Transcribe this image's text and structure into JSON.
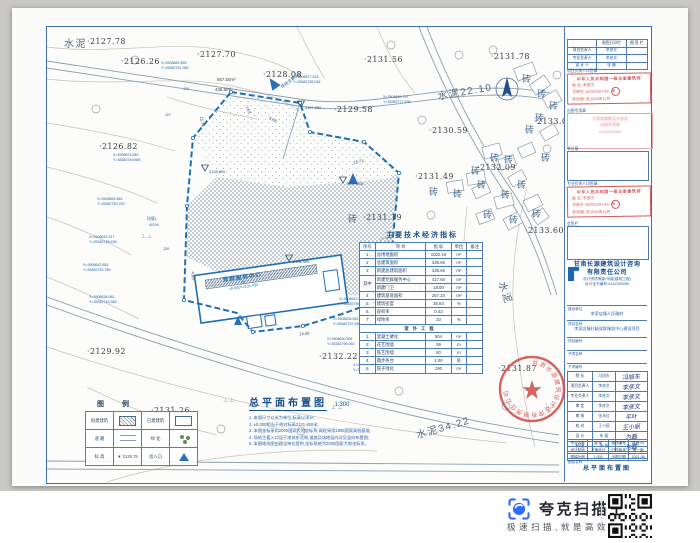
{
  "colors": {
    "frame_blue": "#3f6fae",
    "boundary_blue": "#1f6fb5",
    "stamp_red": "#cf4a4a",
    "brand_blue": "#2f6bff",
    "contour_tan": "#c8c1b2"
  },
  "drawing": {
    "title": "总平面布置图",
    "scale": "1:300",
    "notes": [
      "1. 本图尺寸以米为单位,标高以米计;",
      "2. ±0.000相当于绝对标高2131.450米;",
      "3. 本图坐标采用2000国家大地坐标系,高程采用1985国家高程基准;",
      "4. 场地主要入口设于地块东北侧,道路及场地竖向详见竖向布置图;",
      "5. 本图地形图由建设单位提供,坐标系统为2000国家大地坐标系。"
    ]
  },
  "map": {
    "brick_char": "砖",
    "grass_char": "⊥⊥",
    "entrance_label": "场地主要入口",
    "building": {
      "name": "党群服务中心",
      "floor": "1F",
      "elev": "±0.000=2131.450"
    },
    "spot_elevations": [
      {
        "x": 40,
        "y": 10,
        "t": "2127.78"
      },
      {
        "x": 74,
        "y": 30,
        "t": "2126.26"
      },
      {
        "x": 150,
        "y": 23,
        "t": "2127.70"
      },
      {
        "x": 216,
        "y": 43,
        "t": "2128.08"
      },
      {
        "x": 287,
        "y": 78,
        "t": "2129.58"
      },
      {
        "x": 317,
        "y": 28,
        "t": "2131.56"
      },
      {
        "x": 444,
        "y": 25,
        "t": "2131.78"
      },
      {
        "x": 52,
        "y": 115,
        "t": "2126.82"
      },
      {
        "x": 382,
        "y": 99,
        "t": "2130.59"
      },
      {
        "x": 487,
        "y": 90,
        "t": "2133.07"
      },
      {
        "x": 368,
        "y": 145,
        "t": "2131.49"
      },
      {
        "x": 430,
        "y": 136,
        "t": "2132.09"
      },
      {
        "x": 316,
        "y": 186,
        "t": "2131.19"
      },
      {
        "x": 478,
        "y": 199,
        "t": "2133.60"
      },
      {
        "x": 40,
        "y": 320,
        "t": "2129.92"
      },
      {
        "x": 272,
        "y": 325,
        "t": "2132.22"
      },
      {
        "x": 451,
        "y": 337,
        "t": "2131.87"
      },
      {
        "x": 104,
        "y": 379,
        "t": "2131.26"
      },
      {
        "x": 362,
        "y": 256,
        "t": "2131.67"
      }
    ],
    "region_labels": [
      {
        "x": 17,
        "y": 8,
        "t": "水泥",
        "rot": 0
      },
      {
        "x": 390,
        "y": 56,
        "t": "水泥22.10",
        "rot": -10
      },
      {
        "x": 448,
        "y": 258,
        "t": "水泥",
        "rot": 72
      },
      {
        "x": 368,
        "y": 392,
        "t": "水泥34.22",
        "rot": -16
      }
    ],
    "bricks": [
      {
        "x": 475,
        "y": 45
      },
      {
        "x": 490,
        "y": 60
      },
      {
        "x": 502,
        "y": 72
      },
      {
        "x": 488,
        "y": 84
      },
      {
        "x": 478,
        "y": 96
      },
      {
        "x": 443,
        "y": 124
      },
      {
        "x": 457,
        "y": 126
      },
      {
        "x": 494,
        "y": 124
      },
      {
        "x": 424,
        "y": 137
      },
      {
        "x": 430,
        "y": 151
      },
      {
        "x": 470,
        "y": 151
      },
      {
        "x": 454,
        "y": 161
      },
      {
        "x": 406,
        "y": 160
      },
      {
        "x": 382,
        "y": 158
      },
      {
        "x": 436,
        "y": 181
      },
      {
        "x": 462,
        "y": 186
      },
      {
        "x": 485,
        "y": 180
      },
      {
        "x": 301,
        "y": 185
      }
    ],
    "coord_callouts": [
      {
        "x": 114,
        "y": 34,
        "xv": "X=3908682.855",
        "yv": "Y=35382751.380"
      },
      {
        "x": 246,
        "y": 48,
        "xv": "X=3908677.215",
        "yv": "Y=35382766.044"
      },
      {
        "x": 336,
        "y": 68,
        "xv": "X=3908669.757",
        "yv": "Y=35382777.536"
      },
      {
        "x": 66,
        "y": 126,
        "xv": "X=3908674.840",
        "yv": "Y=35382749.865"
      },
      {
        "x": 50,
        "y": 170,
        "xv": "X=3908652.882",
        "yv": "Y=35382750.750"
      },
      {
        "x": 42,
        "y": 208,
        "xv": "X=3908643.217",
        "yv": "Y=35382748.638"
      },
      {
        "x": 36,
        "y": 236,
        "xv": "X=3908642.851",
        "yv": "Y=35382743.789"
      },
      {
        "x": 42,
        "y": 268,
        "xv": "X=3908638.081",
        "yv": "Y=35382743.366"
      },
      {
        "x": 292,
        "y": 270,
        "xv": "X=3908642.864",
        "yv": "Y=35382796.363"
      },
      {
        "x": 286,
        "y": 290,
        "xv": "X=3908635.961",
        "yv": "Y=35382797.969"
      },
      {
        "x": 280,
        "y": 310,
        "xv": "X=3908630.654",
        "yv": "Y=35382796.062"
      },
      {
        "x": 306,
        "y": 336,
        "xv": "X=3908626.177",
        "yv": "Y=35382757.662"
      },
      {
        "x": 402,
        "y": 240,
        "xv": "X=3908669.751",
        "yv": "Y=35382775.536"
      },
      {
        "x": 406,
        "y": 262,
        "xv": "X=3908638.347",
        "yv": "Y=35382788.062"
      }
    ],
    "dims": [
      {
        "x": 306,
        "y": 132,
        "t": "13.71",
        "rot": -12
      },
      {
        "x": 252,
        "y": 304,
        "t": "14.49",
        "rot": -4
      },
      {
        "x": 222,
        "y": 90,
        "t": "6.66",
        "rot": 25
      },
      {
        "x": 197,
        "y": 80,
        "t": "7.63",
        "rot": 65
      },
      {
        "x": 150,
        "y": 92,
        "t": "15.74",
        "rot": 80
      },
      {
        "x": 142,
        "y": 246,
        "t": "4.09",
        "rot": 85
      }
    ],
    "areas": [
      {
        "x": 170,
        "y": 50,
        "t": "567.50m²"
      },
      {
        "x": 168,
        "y": 60,
        "t": "436.9m²"
      }
    ],
    "misc": [
      {
        "x": 100,
        "y": 190,
        "t": "挡墙1"
      },
      {
        "x": 102,
        "y": 196,
        "t": "4/S04"
      },
      {
        "x": 116,
        "y": 220,
        "t": "J26"
      },
      {
        "x": 118,
        "y": 86,
        "t": "J27"
      },
      {
        "x": 136,
        "y": 60,
        "t": "J20"
      }
    ],
    "grass": [
      {
        "x": 176,
        "y": 370
      },
      {
        "x": 284,
        "y": 377
      },
      {
        "x": 497,
        "y": 376
      },
      {
        "x": 94,
        "y": 206
      }
    ],
    "elev_markers": [
      {
        "x": 162,
        "y": 142,
        "t": "2128.800"
      },
      {
        "x": 258,
        "y": 78,
        "t": "2127.850"
      },
      {
        "x": 300,
        "y": 154,
        "t": "2129.825"
      },
      {
        "x": 246,
        "y": 232,
        "t": "2131.450"
      }
    ]
  },
  "indicators": {
    "title": "主要技术经济指标",
    "headers": [
      "序号",
      "项  目",
      "指  标",
      "单位",
      "备注"
    ],
    "rows": [
      [
        "1",
        "总用地面积",
        "1022.19",
        "m²",
        ""
      ],
      [
        "2",
        "总建筑面积",
        "435.60",
        "m²",
        ""
      ],
      [
        "3",
        "新建总建筑面积",
        "435.60",
        "m²",
        ""
      ],
      [
        "其中",
        "新建党群服务中心",
        "417.60",
        "m²",
        ""
      ],
      [
        "",
        "新建门卫",
        "18.00",
        "m²",
        ""
      ],
      [
        "4",
        "建筑基底面积",
        "257.10",
        "m²",
        ""
      ],
      [
        "5",
        "建筑密度",
        "26.93",
        "%",
        ""
      ],
      [
        "6",
        "容积率",
        "0.43",
        "",
        ""
      ],
      [
        "7",
        "绿地率",
        "33",
        "%",
        ""
      ]
    ],
    "section": "室外工程",
    "rows2": [
      [
        "1",
        "混凝土硬化",
        "504",
        "m²",
        ""
      ],
      [
        "2",
        "花艺围墙",
        "39",
        "m",
        ""
      ],
      [
        "3",
        "铁艺围墙",
        "60",
        "m",
        ""
      ],
      [
        "4",
        "踏步条台",
        "1.00",
        "处",
        ""
      ],
      [
        "5",
        "院子绿化",
        "190",
        "m²",
        ""
      ]
    ]
  },
  "legend": {
    "title": "图  例",
    "elev_value": "2128.75",
    "items": [
      {
        "label": "拟建建筑",
        "symbol": "hatch"
      },
      {
        "label": "已建建筑",
        "symbol": "rect"
      },
      {
        "label": "道  路",
        "symbol": "road"
      },
      {
        "label": "绿  化",
        "symbol": "green"
      },
      {
        "label": "标  高",
        "symbol": "elev"
      },
      {
        "label": "总入口",
        "symbol": "entry"
      }
    ]
  },
  "titleblock": {
    "top_table": {
      "header": [
        "",
        "图签打印栏",
        "图 签 栏"
      ],
      "rows": [
        [
          "项目负责人",
          "李彦文"
        ],
        [
          "专业负责人",
          "李彦文"
        ],
        [
          "设 计 人",
          "张 巍"
        ]
      ]
    },
    "sec_labels": [
      "项目负责人印签章",
      "出图专用章",
      "单位章",
      "专业负责人印签章",
      "会签栏"
    ],
    "stamp": {
      "line1": "中华人民共和国一级注册建筑师",
      "name_label": "姓 名:",
      "name": "李彦文",
      "reg_label": "注册号:",
      "reg": "6200229-016",
      "valid_label": "有效期:",
      "valid": "至2026年11月",
      "seal_char": "章"
    },
    "pink_stamp": [
      "甘肃省勘察设计协会",
      "出图专用章",
      "A162005085"
    ],
    "company": {
      "name1": "甘肃长源建筑设计咨询",
      "name2": "有限责任公司",
      "grade": "设计资质等级:甲级(建筑工程)",
      "cert": "设计证书编号:A162005085"
    },
    "fields": [
      {
        "label": "建设单位",
        "value": "李家店镇人民政府"
      },
      {
        "label": "项目名称",
        "value": "李家店镇村级党群服务中心建设项目"
      },
      {
        "label": "项目编号",
        "value": ""
      },
      {
        "label": "子项名称",
        "value": ""
      },
      {
        "label": "子项编号",
        "value": ""
      }
    ],
    "sign_rows": [
      {
        "label": "院  长",
        "name": "冯旭东",
        "sig": "冯旭东"
      },
      {
        "label": "项目负责人",
        "name": "李彦文",
        "sig": "李彦文"
      },
      {
        "label": "专业负责人",
        "name": "李彦文",
        "sig": "李彦文"
      },
      {
        "label": "审  定",
        "name": "李彦文",
        "sig": "李彦文"
      },
      {
        "label": "审  核",
        "name": "张永红",
        "sig": "平叶"
      },
      {
        "label": "校  对",
        "name": "王小丽",
        "sig": "王小丽"
      },
      {
        "label": "设  计",
        "name": "朱  磊",
        "sig": "为磊"
      },
      {
        "label": "制  图",
        "name": "朱  磊",
        "sig": "为磊"
      }
    ],
    "meta_rows": [
      {
        "l1": "专业名称",
        "v1": "建 筑",
        "l2": "图档编号",
        "v2": "建施-01"
      },
      {
        "l1": "设计阶段",
        "v1": "方案设计",
        "l2": "归档版本",
        "v2": "第一版"
      },
      {
        "l1": "图幅比例",
        "v1": "1:300",
        "l2": "出图日期",
        "v2": "2021.08"
      }
    ],
    "sheet_name_label": "图纸名称",
    "sheet_name": "总平面布置图",
    "seal_text": "甘肃长源建筑设计咨询有限责任公司"
  },
  "footer": {
    "brand": "夸克扫描王",
    "tagline": "极速扫描,就是高效"
  }
}
